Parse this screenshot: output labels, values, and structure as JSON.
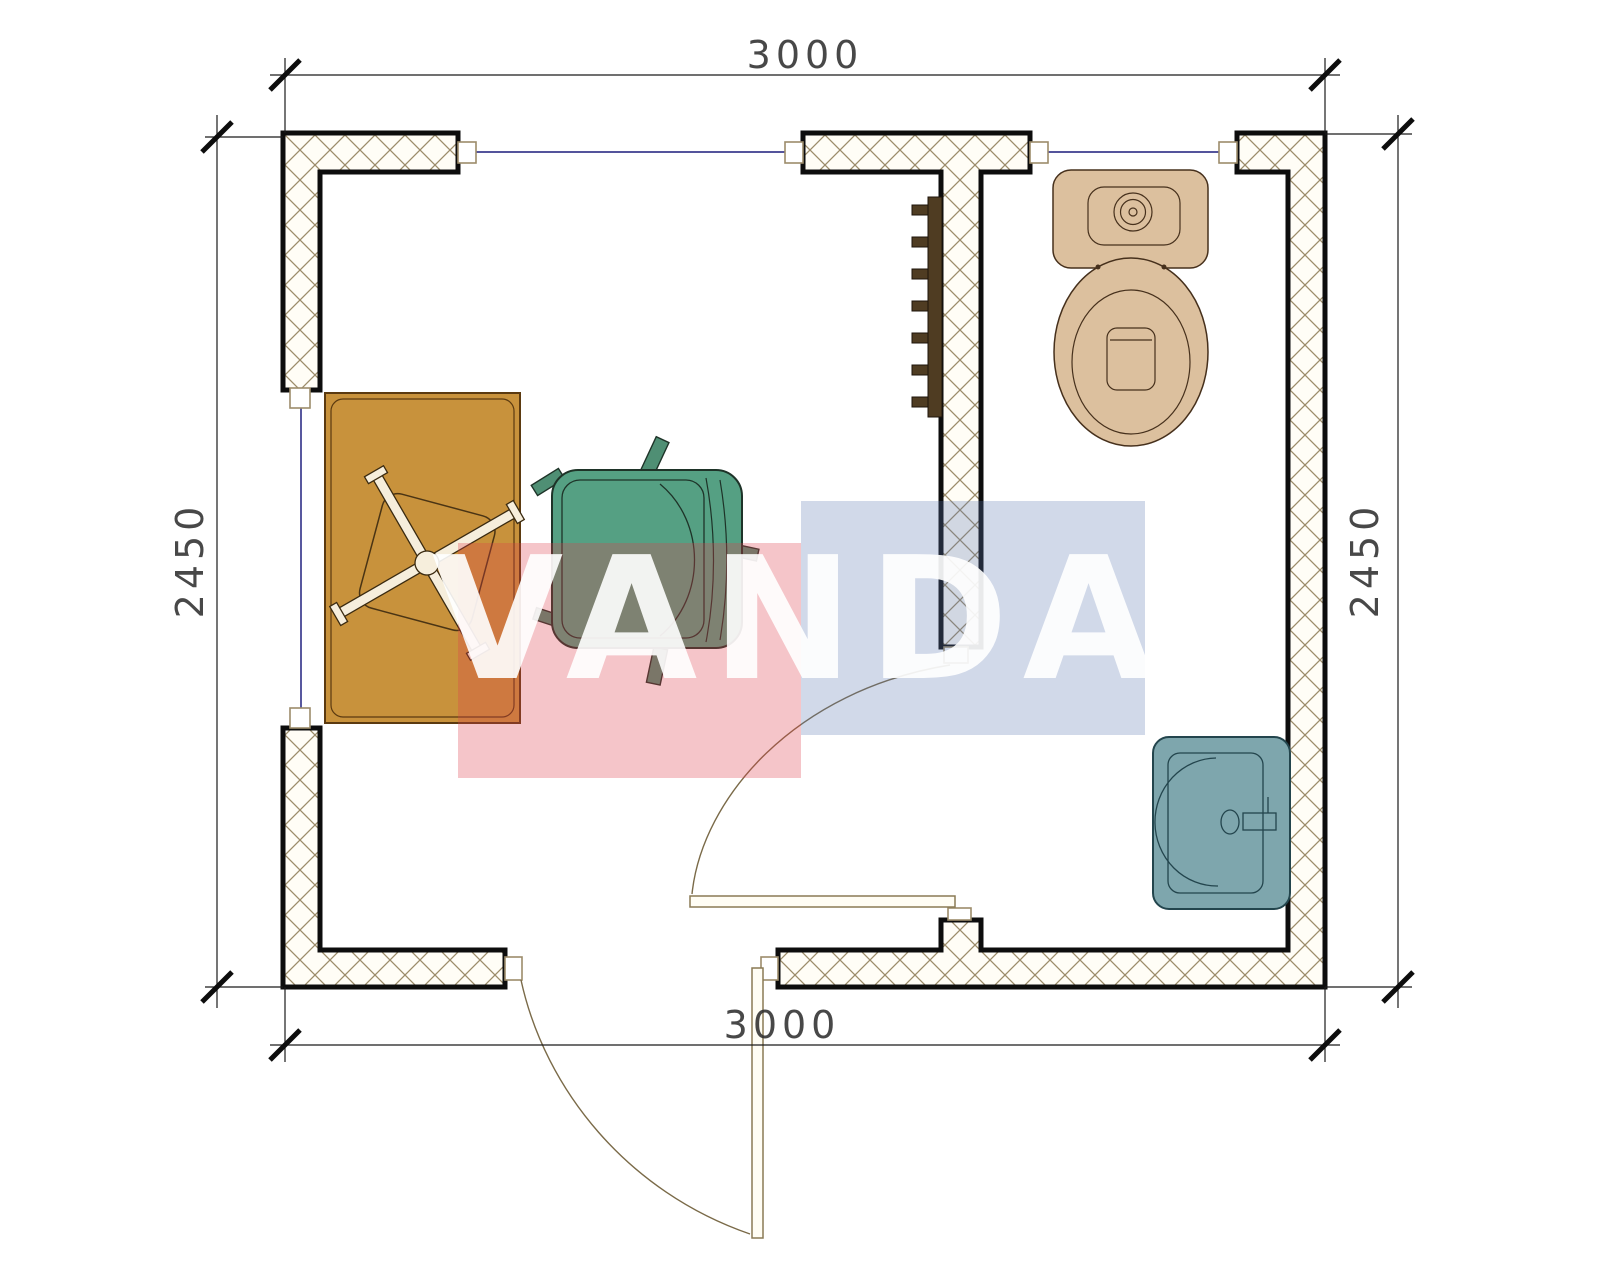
{
  "watermark": {
    "text": "VANDA",
    "red_block_color": "rgba(221,64,75,0.30)",
    "blue_block_color": "rgba(90,120,175,0.28)",
    "text_color": "rgba(255,255,255,0.90)"
  },
  "dimensions": {
    "top": "3000",
    "bottom": "3000",
    "left": "2450",
    "right": "2450",
    "units": "mm"
  },
  "plan": {
    "type": "floor-plan",
    "rooms": [
      "main-room",
      "toilet-room"
    ],
    "fixtures": [
      "desk",
      "office-chair-x-base",
      "armchair",
      "radiator",
      "toilet",
      "sink"
    ],
    "doors": [
      "exterior-door-bottom",
      "interior-door-toilet"
    ],
    "windows": [
      "left-window",
      "top-left-window",
      "top-right-window"
    ]
  },
  "colors": {
    "desk": "#c8923c",
    "armchair": "#55a083",
    "toilet": "#dcc09e",
    "sink": "#7ea6ad",
    "radiator": "#4f3c22",
    "wall_hatch": "#9c8c6a",
    "window_line": "#3b3b8e",
    "dimension": "#2f2f2f"
  }
}
